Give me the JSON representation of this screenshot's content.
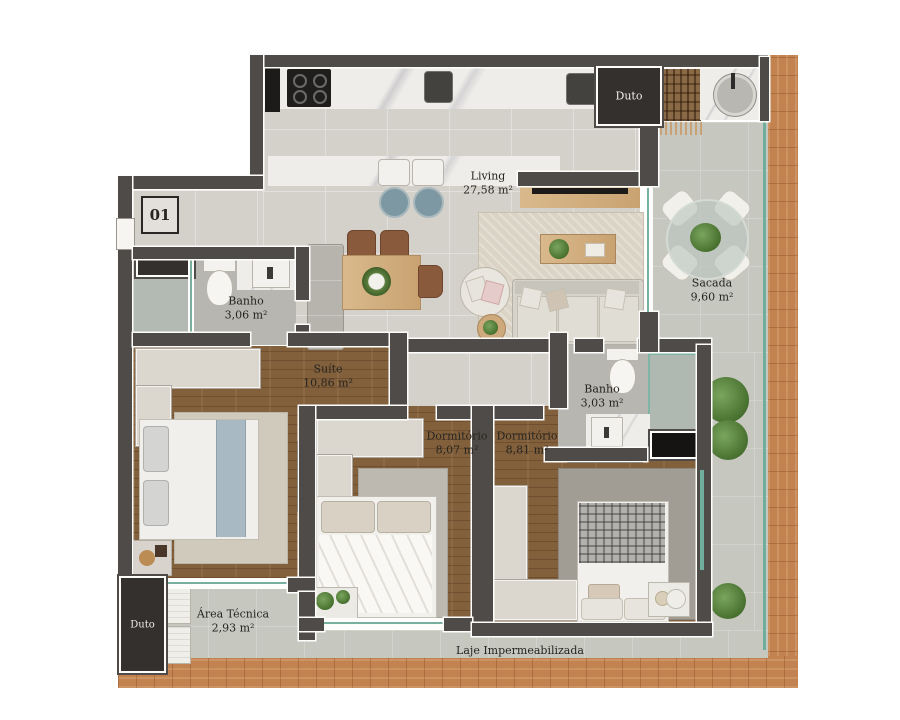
{
  "plan": {
    "unit_badge": "01",
    "rooms": {
      "living": {
        "name": "Living",
        "area": "27,58 m²"
      },
      "banho_social": {
        "name": "Banho",
        "area": "3,06 m²"
      },
      "sacada": {
        "name": "Sacada",
        "area": "9,60 m²"
      },
      "suite": {
        "name": "Suíte",
        "area": "10,86 m²"
      },
      "banho_suite": {
        "name": "Banho",
        "area": "3,03 m²"
      },
      "dormitorio_1": {
        "name": "Dormitório",
        "area": "8,07 m²"
      },
      "dormitorio_2": {
        "name": "Dormitório",
        "area": "8,81 m²"
      },
      "area_tecnica": {
        "name": "Área Técnica",
        "area": "2,93 m²"
      }
    },
    "ducts": {
      "top": "Duto",
      "bottom": "Duto"
    },
    "slab_label": "Laje Impermeabilizada",
    "colors": {
      "wall": "#4f4b48",
      "wood_floor": "#83603c",
      "deck": "#c28350",
      "glass": "#77b09e",
      "marble": "#efedea",
      "tile": "#d4d1cb",
      "stool": "#7d98a2"
    }
  }
}
